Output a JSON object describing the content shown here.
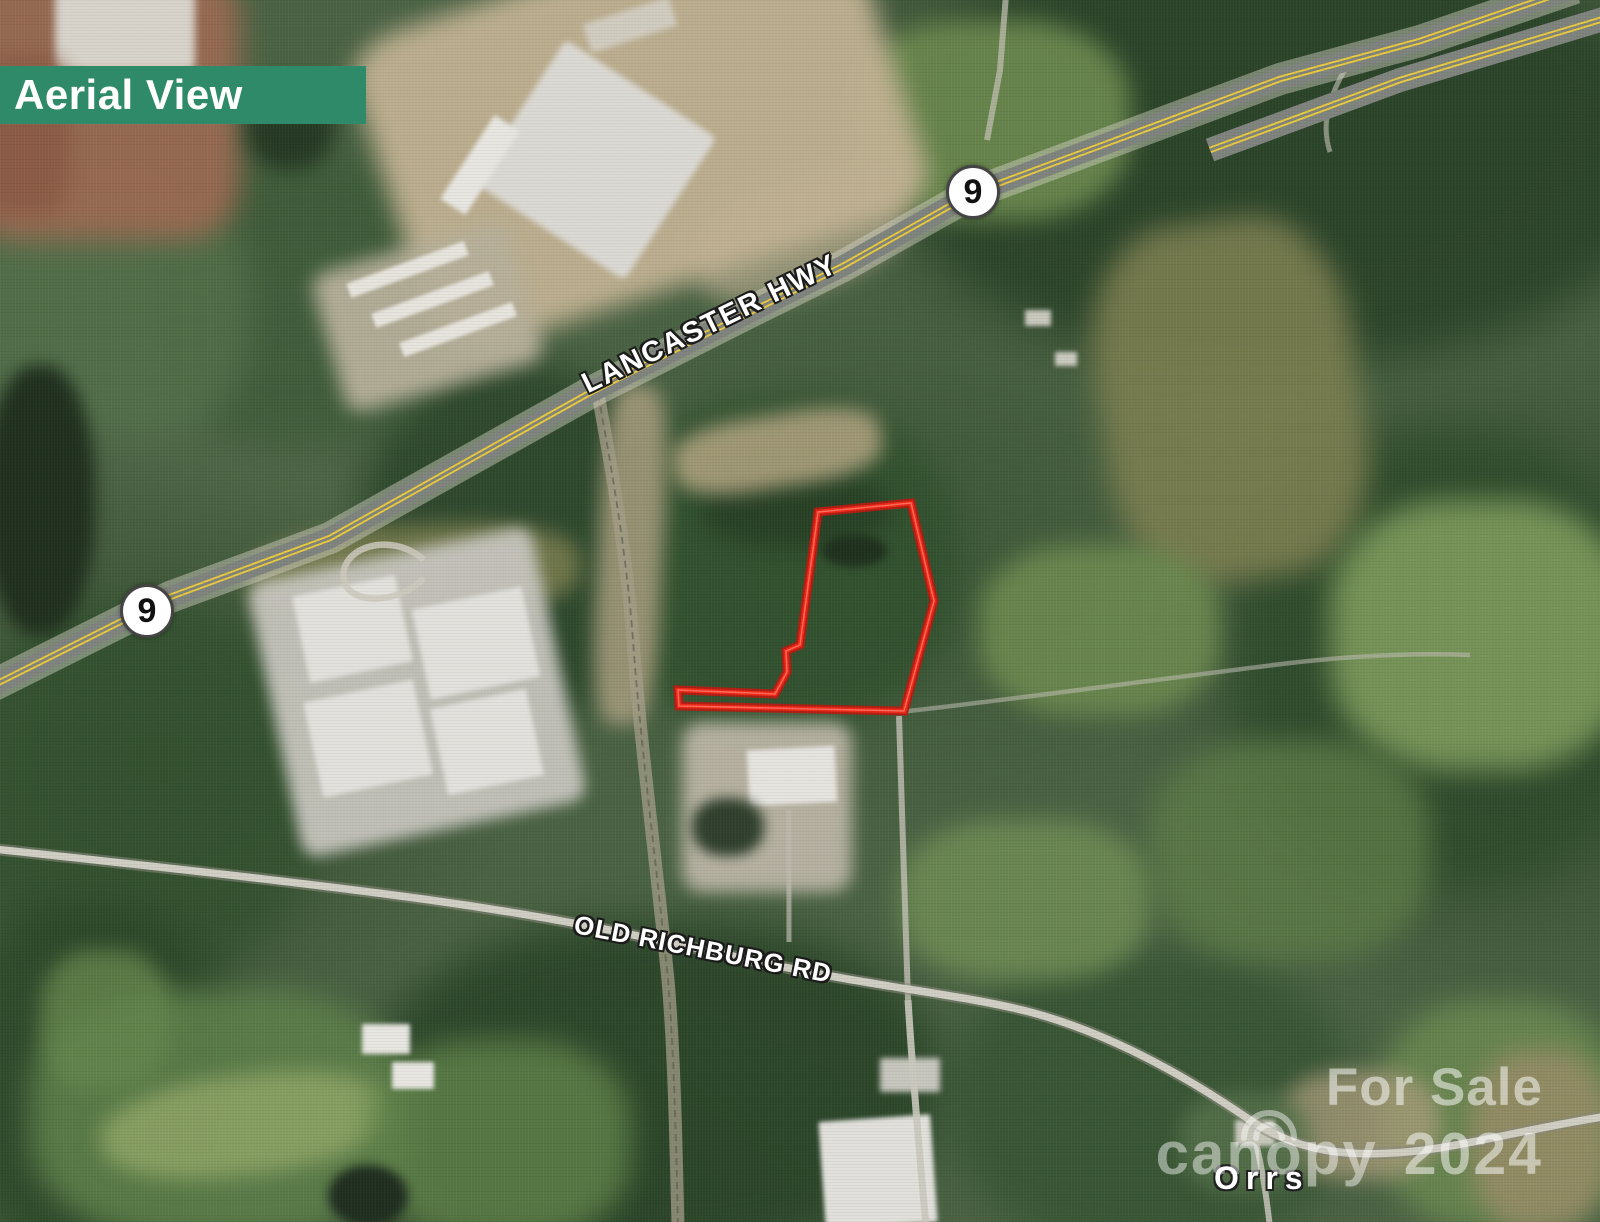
{
  "banner": {
    "label": "Aerial View",
    "bg_color": "#2e8a68"
  },
  "roads": {
    "highway_label": "LANCASTER HWY",
    "secondary_label": "OLD RICHBURG RD",
    "stripe_color": "#e9c93d",
    "route_badges": [
      {
        "number": "9"
      },
      {
        "number": "9"
      }
    ]
  },
  "parcel": {
    "outline_color": "#f02718"
  },
  "place_labels": {
    "town": "Orrs"
  },
  "watermark": {
    "sale_text": "For Sale",
    "brand": "canopy",
    "year": "2024"
  }
}
